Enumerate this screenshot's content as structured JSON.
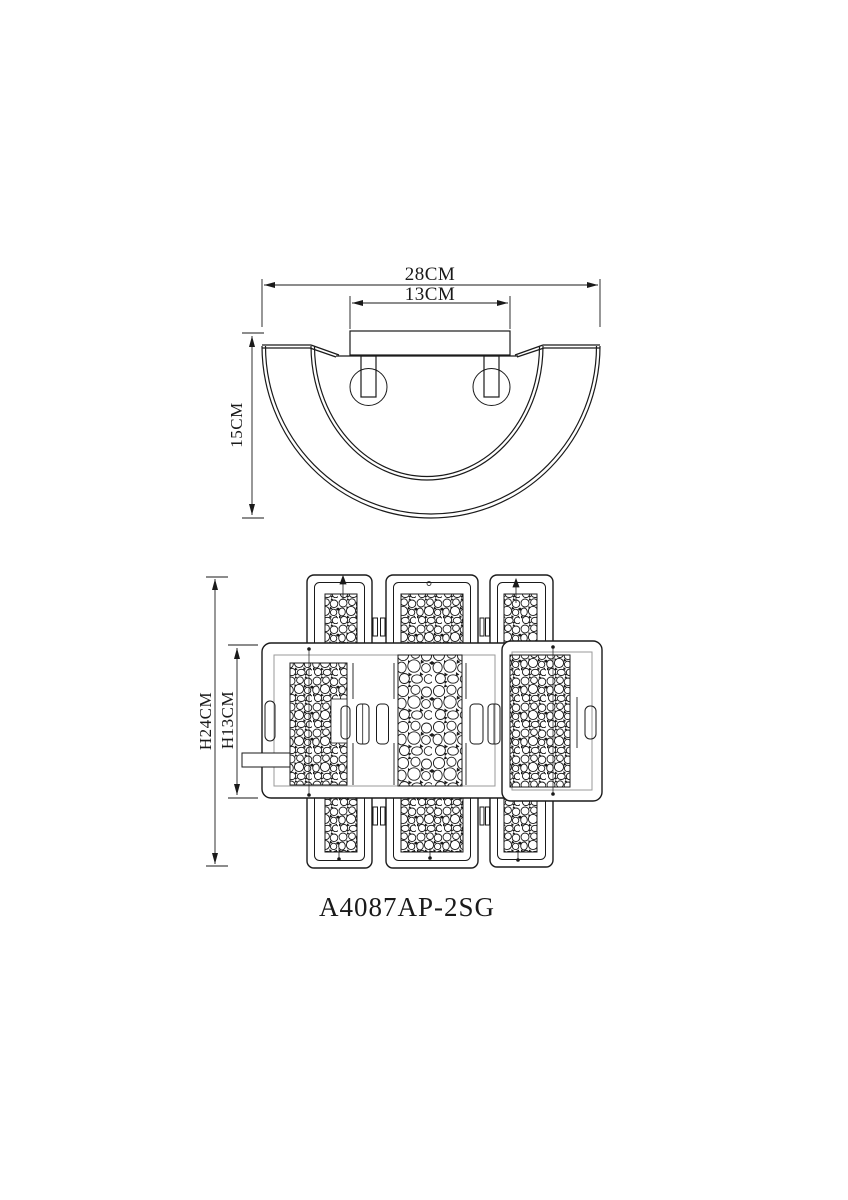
{
  "page": {
    "background": "#ffffff",
    "line_color": "#1a1a1a"
  },
  "side_view": {
    "dims": {
      "total_width": "28CM",
      "plate_width": "13CM",
      "depth": "15CM"
    }
  },
  "front_view": {
    "dims": {
      "total_height": "H24CM",
      "body_height": "H13CM"
    }
  },
  "model_number": "A4087AP-2SG"
}
